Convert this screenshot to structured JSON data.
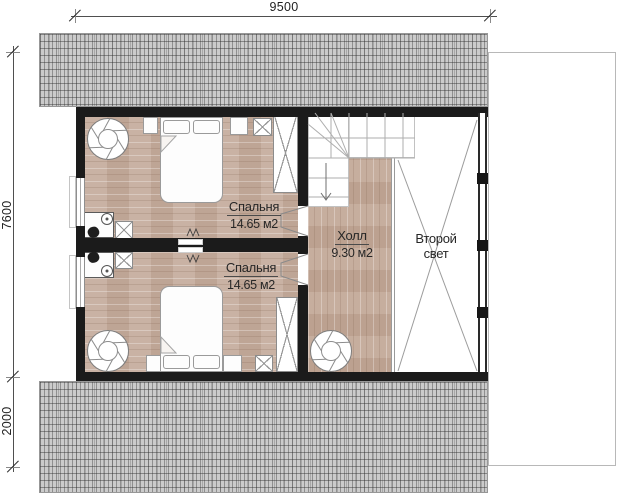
{
  "dimensions": {
    "top_width_mm": "9500",
    "left_height_main_mm": "7600",
    "left_height_lower_mm": "2000"
  },
  "rooms": {
    "bedroom_top": {
      "name": "Спальня",
      "area": "14.65 м2"
    },
    "bedroom_bottom": {
      "name": "Спальня",
      "area": "14.65 м2"
    },
    "hall": {
      "name": "Холл",
      "area": "9.30 м2"
    },
    "second_light": {
      "name_line1": "Второй",
      "name_line2": "свет"
    }
  },
  "colors": {
    "wall": "#1b1b1b",
    "wood_floor": "#c6ad9e",
    "roof": "#cbcbcb",
    "dimension_line": "#4f4f4f"
  }
}
